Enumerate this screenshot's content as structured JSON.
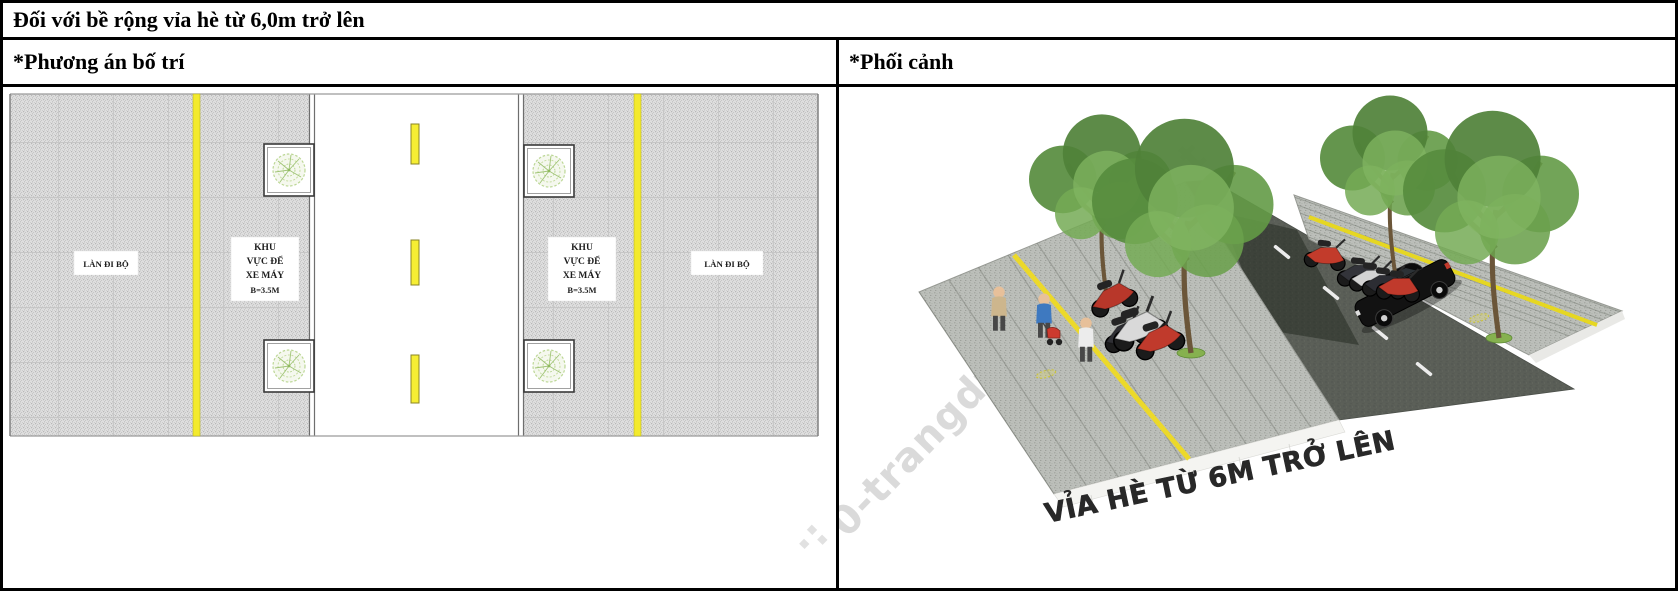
{
  "header": {
    "title": "Đối với bề rộng vỉa hè từ 6,0m trở lên"
  },
  "columns": {
    "left_header": "*Phương án bố trí",
    "right_header": "*Phối cảnh"
  },
  "plan": {
    "walk_lane_label": "LÀN ĐI BỘ",
    "moto_lines": [
      "KHU",
      "VỰC ĐỂ",
      "XE MÁY",
      "B=3.5M"
    ]
  },
  "perspective": {
    "caption": "VỈA HÈ TỪ 6M TRỞ LÊN",
    "watermark": "0-trangdt",
    "watermark_faint": "t",
    "watermark_fragment": "·:"
  },
  "colors": {
    "lane_yellow": "#f2e52e",
    "road_asphalt": "#5a5e57",
    "pavement_gray": "#dedede",
    "pavement_3d": "#bcbfba",
    "tree_green": "#5d9141",
    "caption_ink": "#282828",
    "watermark_gray": "#dadada"
  }
}
